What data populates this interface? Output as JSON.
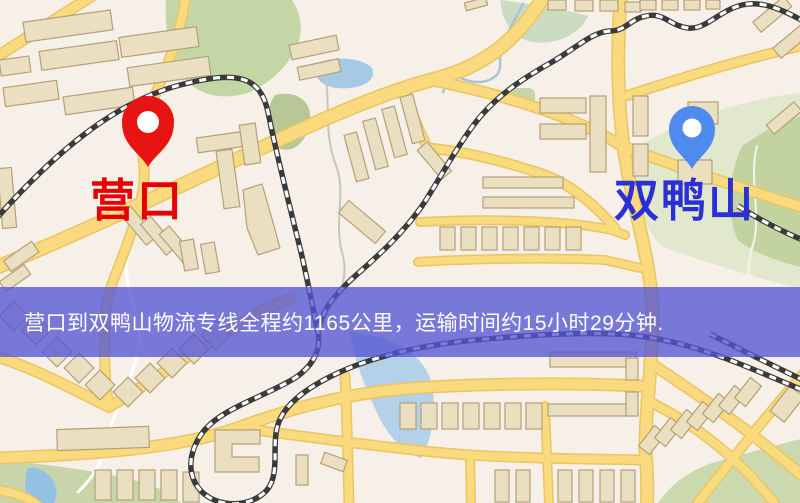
{
  "map": {
    "origin_label": "营口",
    "destination_label": "双鸭山",
    "origin_pin_color": "#e81414",
    "destination_pin_color": "#4f8bee",
    "origin_label_color": "#e60005",
    "destination_label_color": "#2b2fd6"
  },
  "banner": {
    "text": "营口到双鸭山物流专线全程约1165公里，运输时间约15小时29分钟.",
    "background_color": "rgba(84,86,213,0.78)",
    "text_color": "#ffffff"
  }
}
